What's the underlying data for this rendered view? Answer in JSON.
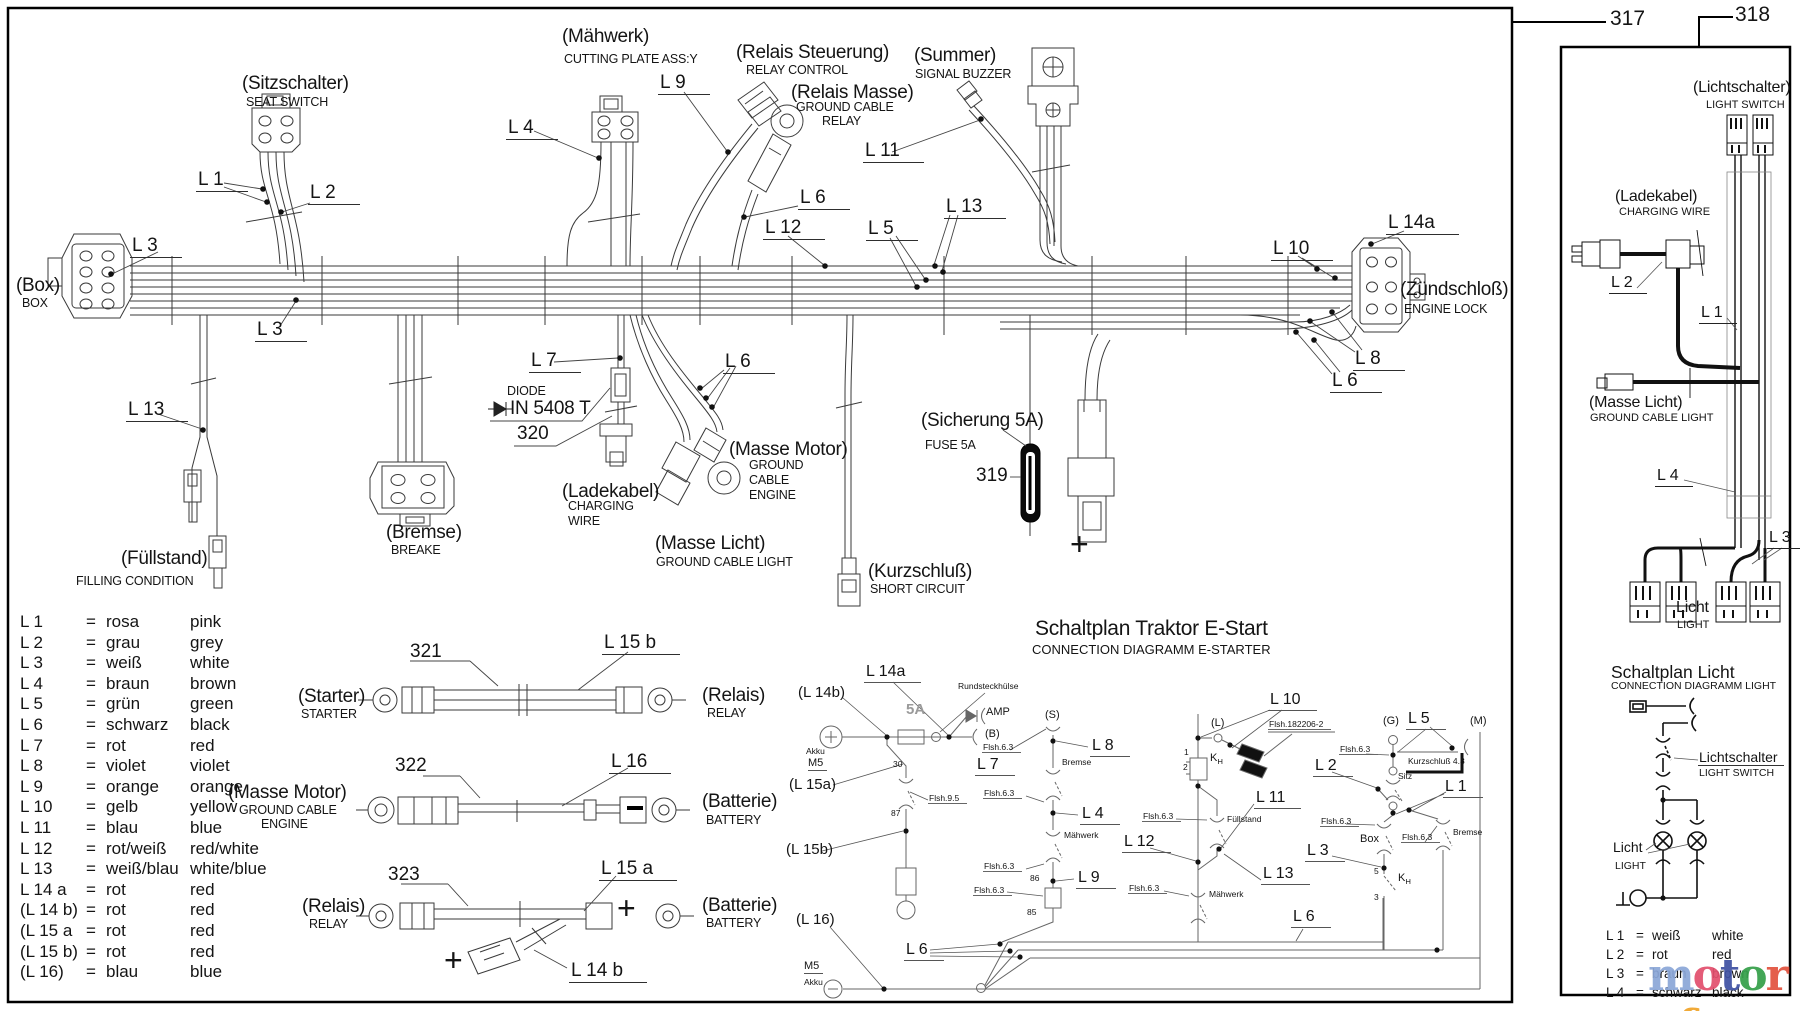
{
  "eq": "=",
  "refs": {
    "r317": "317",
    "r318": "318"
  },
  "harness": {
    "box_de": "(Box)",
    "box_en": "BOX",
    "sitz_de": "(Sitzschalter)",
    "sitz_en": "SEAT SWITCH",
    "maeh_de": "(Mähwerk)",
    "maeh_en": "CUTTING PLATE ASS:Y",
    "rst_de": "(Relais Steuerung)",
    "rst_en": "RELAY CONTROL",
    "rms_de": "(Relais Masse)",
    "rms_en1": "GROUND CABLE",
    "rms_en2": "RELAY",
    "sum_de": "(Summer)",
    "sum_en": "SIGNAL BUZZER",
    "zs_de": "(Zündschloß)",
    "zs_en": "ENGINE LOCK",
    "fue_de": "(Füllstand)",
    "fue_en": "FILLING CONDITION",
    "bre_de": "(Bremse)",
    "bre_en": "BREAKE",
    "dio_1": "DIODE",
    "dio_2": "IN 5408 T",
    "dio_ref": "320",
    "lad_de": "(Ladekabel)",
    "lad_en1": "CHARGING",
    "lad_en2": "WIRE",
    "mm_de": "(Masse Motor)",
    "mm_en1": "GROUND",
    "mm_en2": "CABLE",
    "mm_en3": "ENGINE",
    "mli_de": "(Masse Licht)",
    "mli_en": "GROUND CABLE LIGHT",
    "kur_de": "(Kurzschluß)",
    "kur_en": "SHORT CIRCUIT",
    "sich_de": "(Sicherung 5A)",
    "sich_en": "FUSE 5A",
    "sich_ref": "319",
    "plus": "+"
  },
  "wires": {
    "l1": "L 1",
    "l2": "L 2",
    "l3": "L 3",
    "l4": "L 4",
    "l5": "L 5",
    "l6": "L 6",
    "l7": "L 7",
    "l8": "L 8",
    "l9": "L 9",
    "l10": "L 10",
    "l11": "L 11",
    "l12": "L 12",
    "l13": "L 13",
    "l14a": "L 14a",
    "l15a": "L 15 a",
    "l15b": "L 15 b",
    "l14b": "L 14 b",
    "l16": "L 16"
  },
  "assemblies": {
    "a321": "321",
    "a322": "322",
    "a323": "323",
    "starter_de": "(Starter)",
    "starter_en": "STARTER",
    "relais_de": "(Relais)",
    "relais_en": "RELAY",
    "mm_de": "(Masse Motor)",
    "mm_en1": "GROUND CABLE",
    "mm_en2": "ENGINE",
    "batt_de": "(Batterie)",
    "batt_en": "BATTERY"
  },
  "legend": {
    "rows": [
      {
        "id": "L 1",
        "de": "rosa",
        "en": "pink"
      },
      {
        "id": "L 2",
        "de": "grau",
        "en": "grey"
      },
      {
        "id": "L 3",
        "de": "weiß",
        "en": "white"
      },
      {
        "id": "L 4",
        "de": "braun",
        "en": "brown"
      },
      {
        "id": "L 5",
        "de": "grün",
        "en": "green"
      },
      {
        "id": "L 6",
        "de": "schwarz",
        "en": "black"
      },
      {
        "id": "L 7",
        "de": "rot",
        "en": "red"
      },
      {
        "id": "L 8",
        "de": "violet",
        "en": "violet"
      },
      {
        "id": "L 9",
        "de": "orange",
        "en": "orange"
      },
      {
        "id": "L 10",
        "de": "gelb",
        "en": "yellow"
      },
      {
        "id": "L 11",
        "de": "blau",
        "en": "blue"
      },
      {
        "id": "L 12",
        "de": "rot/weiß",
        "en": "red/white"
      },
      {
        "id": "L 13",
        "de": "weiß/blau",
        "en": "white/blue"
      },
      {
        "id": "L 14 a",
        "de": "rot",
        "en": "red"
      },
      {
        "id": "(L 14 b)",
        "de": "rot",
        "en": "red"
      },
      {
        "id": "(L 15 a",
        "de": "rot",
        "en": "red"
      },
      {
        "id": "(L 15 b)",
        "de": "rot",
        "en": "red"
      },
      {
        "id": "(L 16)",
        "de": "blau",
        "en": "blue"
      }
    ]
  },
  "schematic": {
    "title": "Schaltplan Traktor E-Start",
    "subtitle": "CONNECTION DIAGRAMM E-STARTER",
    "l14a": "L 14a",
    "l14b": "(L 14b)",
    "l15a": "(L 15a)",
    "l15b": "(L 15b)",
    "l16": "(L 16)",
    "amp5": "5A",
    "amp": "AMP",
    "b": "(B)",
    "s": "(S)",
    "l": "(L)",
    "g": "(G)",
    "m": "(M)",
    "rund": "Rundsteckhülse",
    "flsh63": "Flsh.6.3",
    "flsh95": "Flsh.9.5",
    "flsh182": "Flsh.182206-2",
    "akku": "Akku",
    "m5": "M5",
    "n30": "30",
    "n87": "87",
    "n86": "86",
    "n85": "85",
    "n1": "1",
    "n2": "2",
    "n5": "5",
    "n3": "3",
    "kh_k": "K",
    "kh_h": "H",
    "bremse": "Bremse",
    "maehwerk": "Mähwerk",
    "fuellstand": "Füllstand",
    "box": "Box",
    "sitz": "Sitz",
    "kurz48": "Kurzschluß 4.8",
    "l1": "L 1",
    "l2": "L 2",
    "l3": "L 3",
    "l4": "L 4",
    "l5": "L 5",
    "l6": "L 6",
    "l7": "L 7",
    "l8": "L 8",
    "l9": "L 9",
    "l10": "L 10",
    "l11": "L 11",
    "l12": "L 12",
    "l13": "L 13"
  },
  "panel": {
    "licht_sw_de": "(Lichtschalter)",
    "licht_sw_en": "LIGHT SWITCH",
    "lad_de": "(Ladekabel)",
    "lad_en": "CHARGING WIRE",
    "ml_de": "(Masse Licht)",
    "ml_en": "GROUND CABLE LIGHT",
    "licht_de": "Licht",
    "licht_en": "LIGHT",
    "l1": "L 1",
    "l2": "L 2",
    "l3": "L 3",
    "l4": "L 4",
    "title": "Schaltplan Licht",
    "subtitle": "CONNECTION DIAGRAMM LIGHT",
    "c_ls_de": "Lichtschalter",
    "c_ls_en": "LIGHT SWITCH",
    "c_li_de": "Licht",
    "c_li_en": "LIGHT",
    "legend": {
      "rows": [
        {
          "id": "L 1",
          "de": "weiß",
          "en": "white"
        },
        {
          "id": "L 2",
          "de": "rot",
          "en": "red"
        },
        {
          "id": "L 3",
          "de": "braun",
          "en": "brown"
        },
        {
          "id": "L 4",
          "de": "schwarz",
          "en": "black"
        }
      ]
    }
  },
  "watermark": {
    "letters": [
      {
        "ch": "m",
        "c": "#8ba7d8"
      },
      {
        "ch": "o",
        "c": "#e2506e"
      },
      {
        "ch": "t",
        "c": "#3f51a3"
      },
      {
        "ch": "o",
        "c": "#35a04a"
      },
      {
        "ch": "r",
        "c": "#e2533f"
      },
      {
        "ch": "u",
        "c": "#5b84c9"
      },
      {
        "ch": "f",
        "c": "#f0a42a"
      }
    ],
    "suffix": ".de"
  }
}
